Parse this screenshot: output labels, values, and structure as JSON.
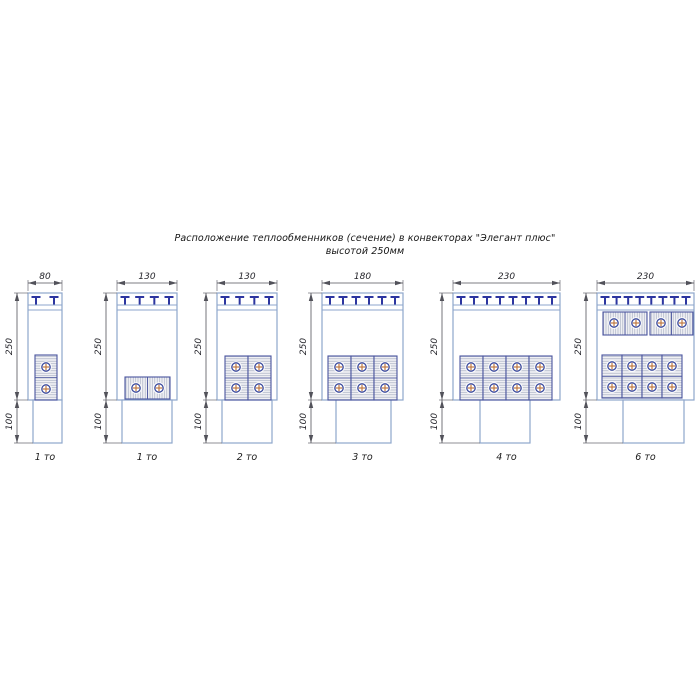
{
  "title": {
    "line1": "Расположение теплообменников (сечение) в конвекторах \"Элегант плюс\"",
    "line2": "высотой 250мм"
  },
  "dim_labels": {
    "height": "250",
    "duct_height": "100"
  },
  "colors": {
    "outline": "#8ea6cc",
    "grille": "#2c35a0",
    "block_border": "#4a559e",
    "block_fill": "#f2f2f5",
    "hatch_line": "#a6aec2",
    "circle_ring": "#3a4a9e",
    "circle_cross": "#c07a42",
    "dim_line": "#52525a",
    "ext_line": "#6a6a72",
    "dim_text": "#26262c",
    "label_text": "#1c1c1c"
  },
  "geometry": {
    "casing_top": 293,
    "casing_bottom": 400,
    "duct_bottom": 443,
    "band_line1": 305,
    "band_line2": 310,
    "top_dim_y": 283,
    "left_dim_offset": 11,
    "width_label_y": 279,
    "figure_label_y": 460
  },
  "figures": [
    {
      "label": "1 то",
      "width_label": "80",
      "x": 28,
      "w": 34,
      "grille_bars": 2,
      "duct": {
        "x": 33,
        "w": 29
      },
      "blocks": [
        {
          "x": 35,
          "y": 355,
          "w": 22,
          "h": 45,
          "hatch": "h",
          "circles": [
            [
              46,
              367
            ],
            [
              46,
              389
            ]
          ]
        }
      ]
    },
    {
      "label": "1 то",
      "width_label": "130",
      "x": 117,
      "w": 60,
      "grille_bars": 4,
      "duct": {
        "x": 122,
        "w": 50
      },
      "blocks": [
        {
          "x": 125,
          "y": 377,
          "w": 45,
          "h": 22,
          "hatch": "v",
          "circles": [
            [
              136,
              388
            ],
            [
              159,
              388
            ]
          ]
        }
      ]
    },
    {
      "label": "2 то",
      "width_label": "130",
      "x": 217,
      "w": 60,
      "grille_bars": 4,
      "duct": {
        "x": 222,
        "w": 50
      },
      "blocks": [
        {
          "x": 225,
          "y": 356,
          "w": 23,
          "h": 44,
          "hatch": "h",
          "circles": [
            [
              236,
              367
            ],
            [
              236,
              388
            ]
          ]
        },
        {
          "x": 248,
          "y": 356,
          "w": 23,
          "h": 44,
          "hatch": "h",
          "circles": [
            [
              259,
              367
            ],
            [
              259,
              388
            ]
          ]
        }
      ]
    },
    {
      "label": "3 то",
      "width_label": "180",
      "x": 322,
      "w": 81,
      "grille_bars": 6,
      "duct": {
        "x": 336,
        "w": 55
      },
      "blocks": [
        {
          "x": 328,
          "y": 356,
          "w": 23,
          "h": 44,
          "hatch": "h",
          "circles": [
            [
              339,
              367
            ],
            [
              339,
              388
            ]
          ]
        },
        {
          "x": 351,
          "y": 356,
          "w": 23,
          "h": 44,
          "hatch": "h",
          "circles": [
            [
              362,
              367
            ],
            [
              362,
              388
            ]
          ]
        },
        {
          "x": 374,
          "y": 356,
          "w": 23,
          "h": 44,
          "hatch": "h",
          "circles": [
            [
              385,
              367
            ],
            [
              385,
              388
            ]
          ]
        }
      ]
    },
    {
      "label": "4 то",
      "width_label": "230",
      "x": 453,
      "w": 107,
      "grille_bars": 8,
      "duct": {
        "x": 480,
        "w": 50
      },
      "blocks": [
        {
          "x": 460,
          "y": 356,
          "w": 23,
          "h": 44,
          "hatch": "h",
          "circles": [
            [
              471,
              367
            ],
            [
              471,
              388
            ]
          ]
        },
        {
          "x": 483,
          "y": 356,
          "w": 23,
          "h": 44,
          "hatch": "h",
          "circles": [
            [
              494,
              367
            ],
            [
              494,
              388
            ]
          ]
        },
        {
          "x": 506,
          "y": 356,
          "w": 23,
          "h": 44,
          "hatch": "h",
          "circles": [
            [
              517,
              367
            ],
            [
              517,
              388
            ]
          ]
        },
        {
          "x": 529,
          "y": 356,
          "w": 23,
          "h": 44,
          "hatch": "h",
          "circles": [
            [
              540,
              367
            ],
            [
              540,
              388
            ]
          ]
        }
      ]
    },
    {
      "label": "6 то",
      "width_label": "230",
      "x": 597,
      "w": 97,
      "grille_bars": 8,
      "duct": {
        "x": 623,
        "w": 61
      },
      "blocks": [
        {
          "x": 603,
          "y": 312,
          "w": 44,
          "h": 23,
          "hatch": "v",
          "circles": [
            [
              614,
              323
            ],
            [
              636,
              323
            ]
          ]
        },
        {
          "x": 650,
          "y": 312,
          "w": 43,
          "h": 23,
          "hatch": "v",
          "circles": [
            [
              661,
              323
            ],
            [
              682,
              323
            ]
          ]
        },
        {
          "x": 602,
          "y": 355,
          "w": 20,
          "h": 43,
          "hatch": "h",
          "circles": [
            [
              612,
              366
            ],
            [
              612,
              387
            ]
          ]
        },
        {
          "x": 622,
          "y": 355,
          "w": 20,
          "h": 43,
          "hatch": "h",
          "circles": [
            [
              632,
              366
            ],
            [
              632,
              387
            ]
          ]
        },
        {
          "x": 642,
          "y": 355,
          "w": 20,
          "h": 43,
          "hatch": "h",
          "circles": [
            [
              652,
              366
            ],
            [
              652,
              387
            ]
          ]
        },
        {
          "x": 662,
          "y": 355,
          "w": 20,
          "h": 43,
          "hatch": "h",
          "circles": [
            [
              672,
              366
            ],
            [
              672,
              387
            ]
          ]
        }
      ]
    }
  ]
}
